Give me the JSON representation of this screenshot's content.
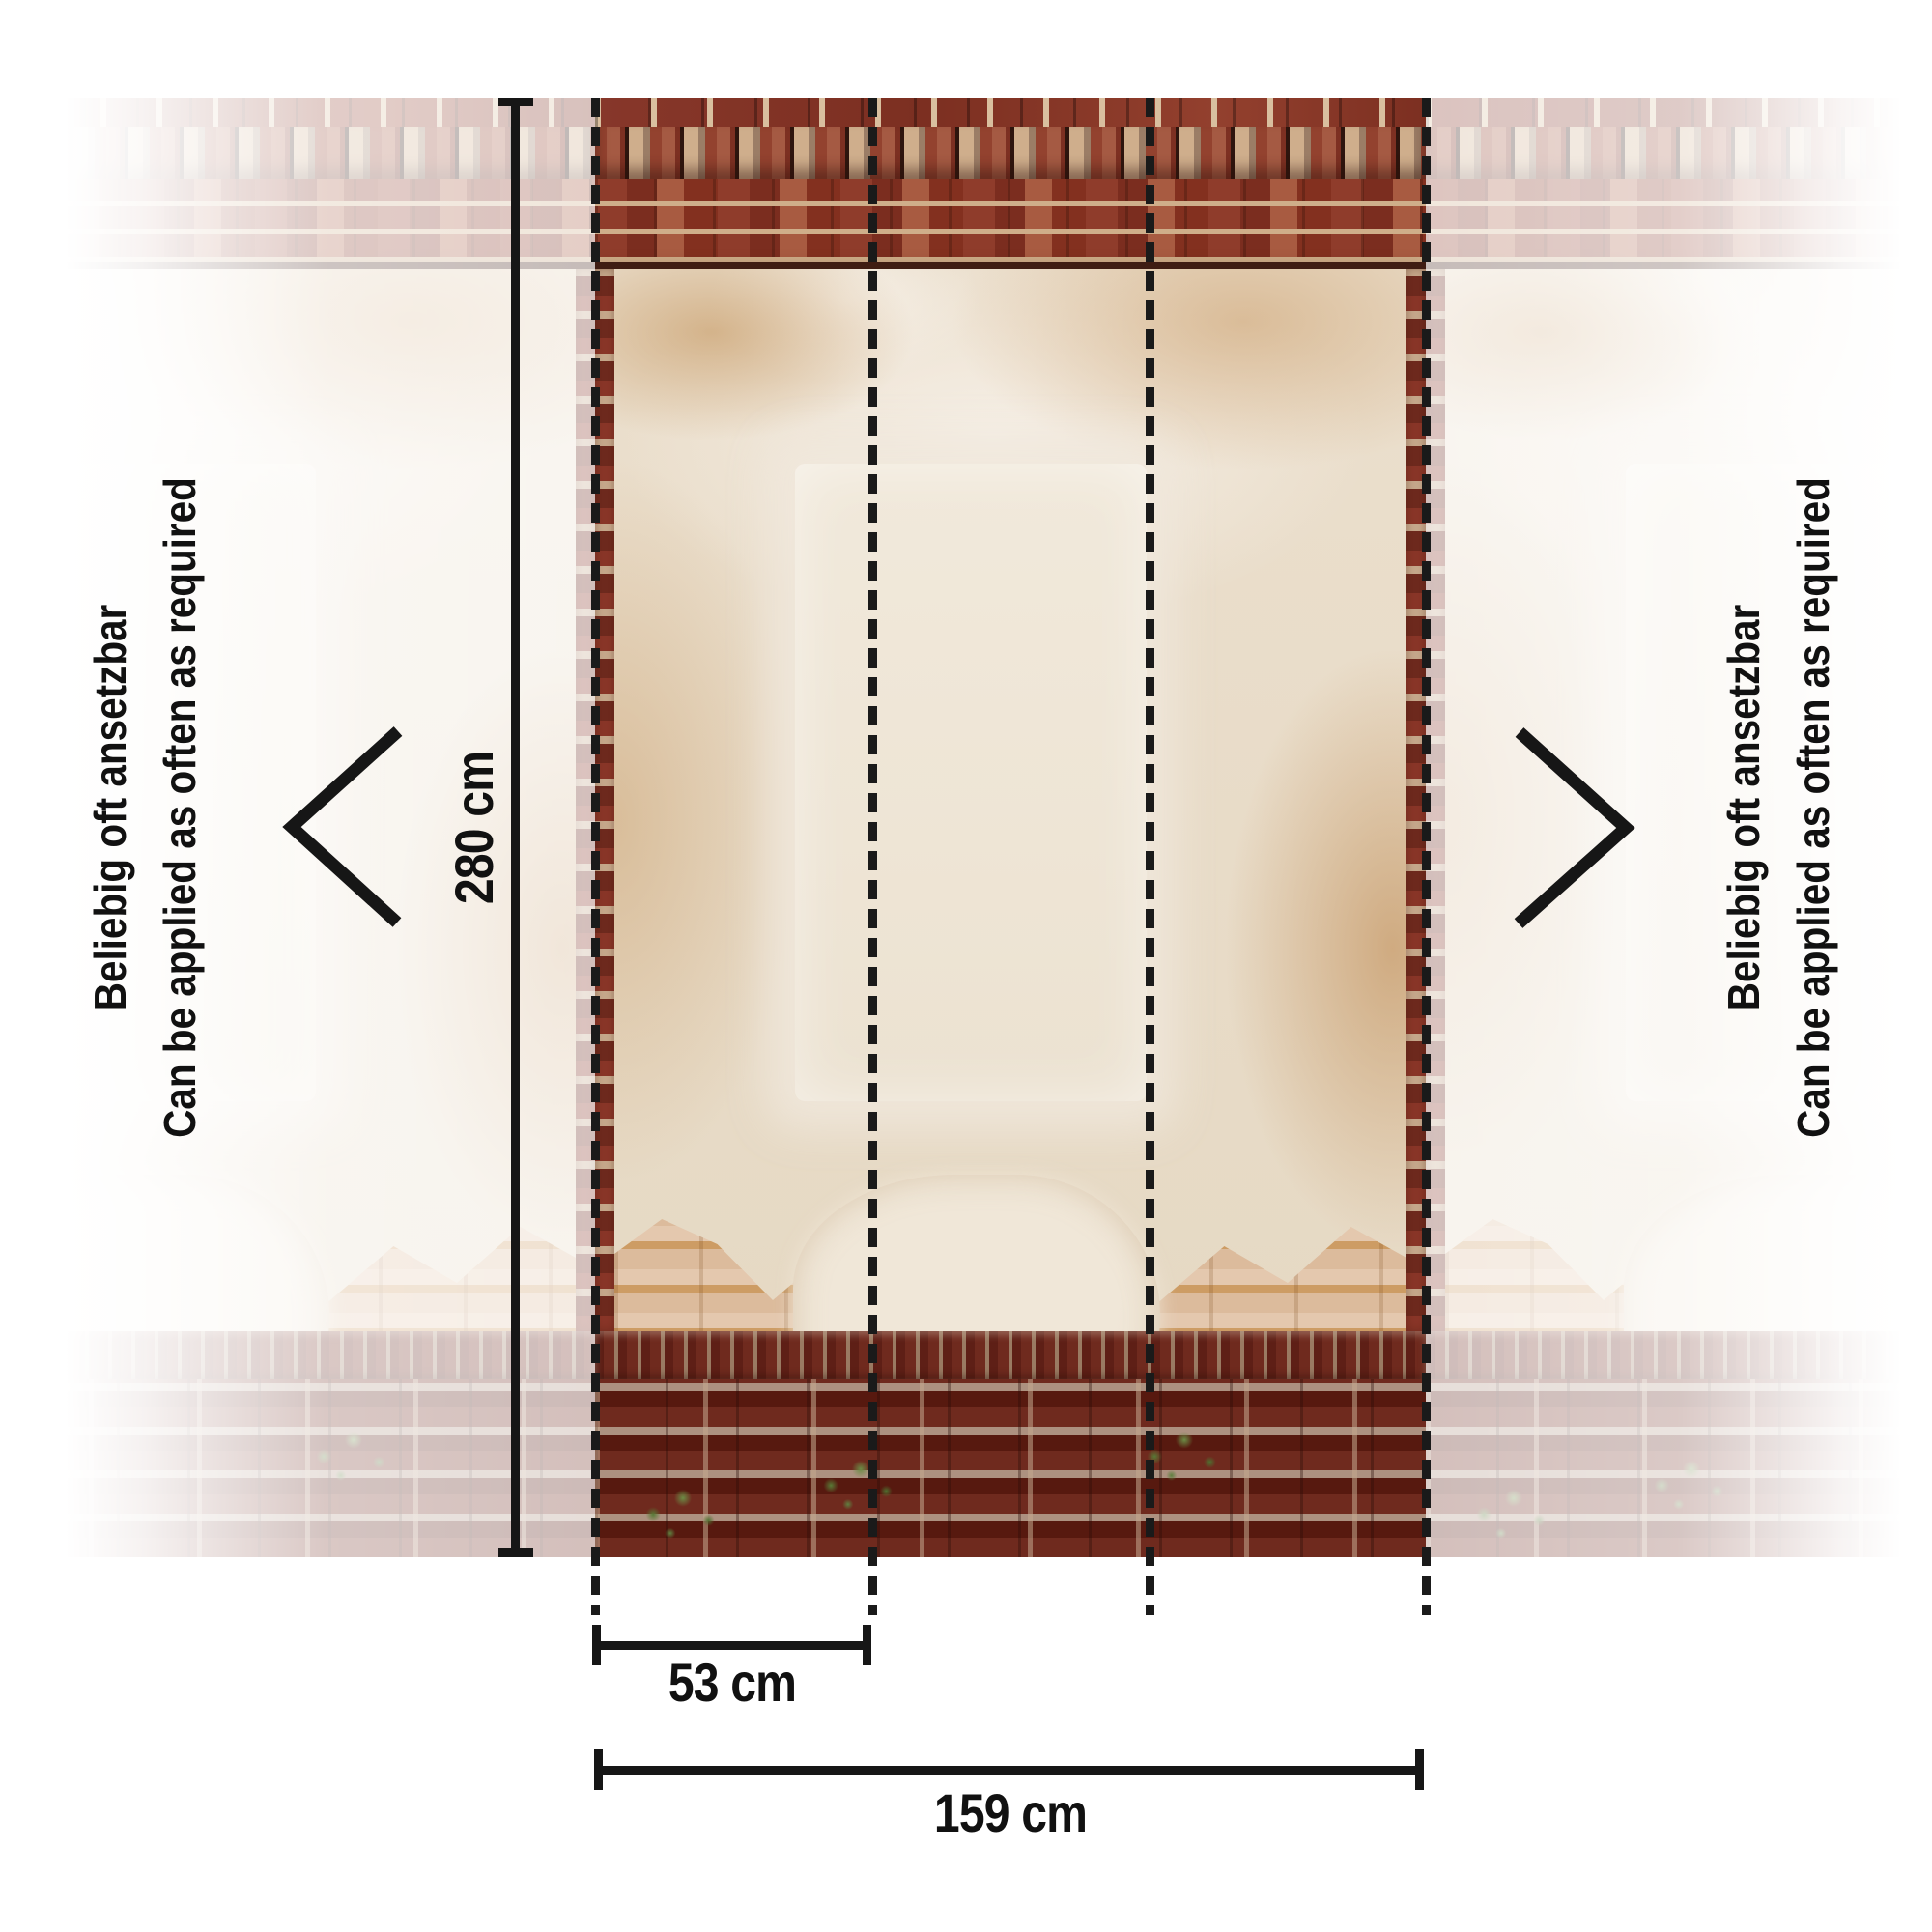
{
  "measurements": {
    "height": "280 cm",
    "strip_width": "53 cm",
    "total_width": "159 cm"
  },
  "repeat_note": {
    "de": "Beliebig oft ansetzbar",
    "en": "Can be applied as often as required"
  },
  "icons": {
    "left": "chevron-left-icon",
    "right": "chevron-right-icon"
  },
  "colors": {
    "annotation": "#161616",
    "background": "#ffffff",
    "cornice_brick": "#8e3b2c",
    "base_brick": "#5e1f16",
    "light_brick": "#ddbd9e",
    "mortar": "#cfae8a",
    "plaster": "#ebdfcd"
  }
}
